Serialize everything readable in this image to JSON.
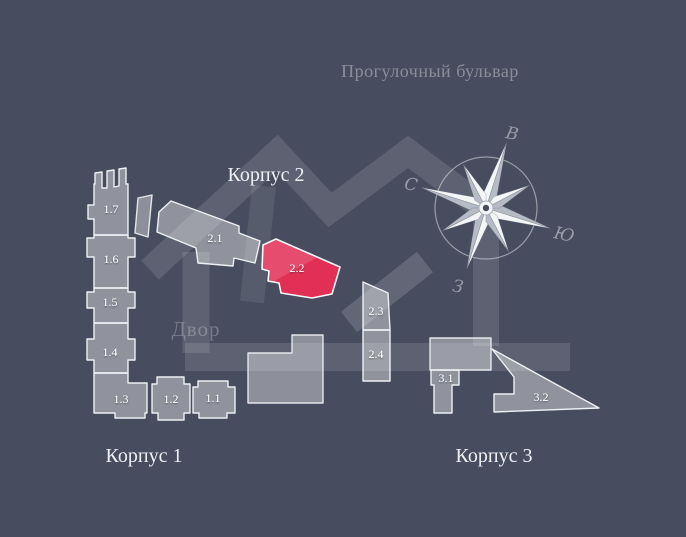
{
  "street_label": "Прогулочный бульвар",
  "courtyard_label": "Двор",
  "buildings": {
    "korpus1": {
      "label": "Корпус 1"
    },
    "korpus2": {
      "label": "Корпус 2"
    },
    "korpus3": {
      "label": "Корпус 3"
    }
  },
  "sections": {
    "s11": {
      "label": "1.1"
    },
    "s12": {
      "label": "1.2"
    },
    "s13": {
      "label": "1.3"
    },
    "s14": {
      "label": "1.4"
    },
    "s15": {
      "label": "1.5"
    },
    "s16": {
      "label": "1.6"
    },
    "s17": {
      "label": "1.7"
    },
    "s21": {
      "label": "2.1"
    },
    "s22": {
      "label": "2.2"
    },
    "s23": {
      "label": "2.3"
    },
    "s24": {
      "label": "2.4"
    },
    "s31": {
      "label": "3.1"
    },
    "s32": {
      "label": "3.2"
    }
  },
  "highlighted_section": "2.2",
  "compass": {
    "north": "С",
    "east": "В",
    "south": "Ю",
    "west": "З"
  },
  "colors": {
    "background": "#474c5e",
    "building_fill": "#9aa0ad",
    "building_border": "#eef0f4",
    "highlight": "#e22f56",
    "muted_text": "#878da0"
  }
}
